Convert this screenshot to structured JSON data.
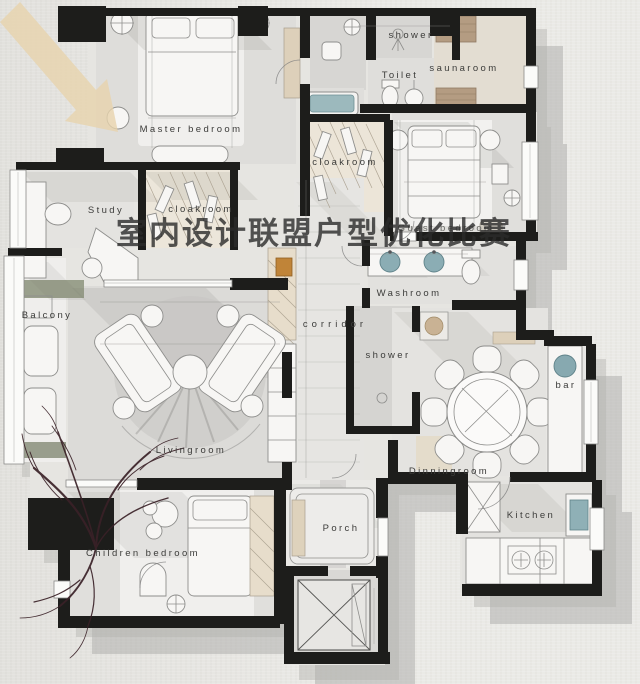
{
  "watermark": {
    "text": "室内设计联盟户型优化比赛"
  },
  "rooms": {
    "master_bedroom": {
      "label": "Master bedroom"
    },
    "study": {
      "label": "Study"
    },
    "cloakroom_master": {
      "label": "cloakroom"
    },
    "shower_top": {
      "label": "shower"
    },
    "toilet": {
      "label": "Toilet"
    },
    "saunaroom": {
      "label": "saunaroom"
    },
    "cloakroom_guest": {
      "label": "cloakroom"
    },
    "guest_bedroom": {
      "label": "Guest bedroom"
    },
    "balcony": {
      "label": "Balcony"
    },
    "corridor": {
      "label": "corridor"
    },
    "washroom": {
      "label": "Washroom"
    },
    "shower_middle": {
      "label": "shower"
    },
    "livingroom": {
      "label": "Livingroom"
    },
    "dinningroom": {
      "label": "Dinningroom"
    },
    "bar": {
      "label": "bar"
    },
    "kitchen": {
      "label": "Kitchen"
    },
    "children_bedroom": {
      "label": "Children bedroom"
    },
    "porch": {
      "label": "Porch"
    }
  },
  "palette": {
    "paper": "#e9e8e4",
    "wall": "#1d1d1b",
    "floor_light": "#f6f5f3",
    "floor_gray": "#dcdbd8",
    "shadow": "#a3a29f",
    "accent_tan": "#ddd0ba",
    "accent_teal": "#8badb4",
    "sauna_wood": "#b49c82",
    "tree": "#3a2127",
    "label_text": "#3b3b39"
  }
}
